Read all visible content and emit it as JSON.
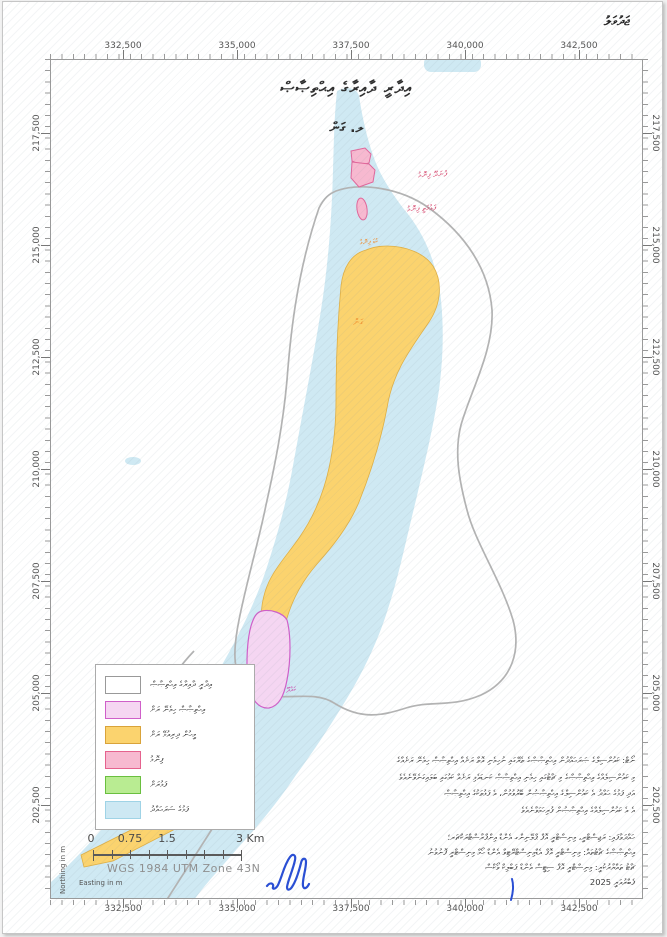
{
  "page": {
    "annex_label": "ޖަދުވަލު",
    "date_label": "ފެބްރުއަރީ 2025"
  },
  "map": {
    "title_line1": "އިދާރީ ދާއިރާގެ އިޙްތިޞާޞް",
    "title_line2": "ލ. ގަން",
    "island_labels": {
      "finolhu_north": "ފުނަދޫ ފިނޮޅު",
      "finolhu_mid": "ފަޅުމަތީ ފިނޮޅު",
      "finolhu_small": "ކުޑަ ފިނޮޅު",
      "gan": "ގަން",
      "kahdhoo": "ކައްދޫ"
    },
    "colors": {
      "lagoon": "#cfe9f3",
      "inhabited_island": "#fbd36e",
      "jurisdiction_island": "#f5d6f2",
      "sandbank": "#f7b9d0",
      "uninhabited_island": "#b9ec92",
      "boundary": "#b3b3b3",
      "label_red": "#d6486e",
      "label_orange": "#ef8d2f",
      "label_magenta": "#cc3fa8",
      "signature_blue": "#2a4fd4"
    }
  },
  "axes": {
    "top": [
      "332,500",
      "335,000",
      "337,500",
      "340,000",
      "342,500"
    ],
    "bottom": [
      "332,500",
      "335,000",
      "337,500",
      "340,000",
      "342,500"
    ],
    "left": [
      "217,500",
      "215,000",
      "212,500",
      "210,000",
      "207,500",
      "205,000",
      "202,500"
    ],
    "right": [
      "217,500",
      "215,000",
      "212,500",
      "210,000",
      "207,500",
      "205,000",
      "202,500"
    ],
    "x_axis_label": "Easting in m",
    "y_axis_label": "Northing in m"
  },
  "legend": {
    "items": [
      {
        "label": "އިދާރީ ދާއިރާގެ އިޙްތިޞާޞް",
        "fill": "#ffffff",
        "stroke": "#999999"
      },
      {
        "label": "އިޙްތިޞާޞް ހިމެނޭ ރަށް",
        "fill": "#f5d6f2",
        "stroke": "#cf5fc9"
      },
      {
        "label": "މީހުން ދިރިއުޅޭ ރަށް",
        "fill": "#fbd36e",
        "stroke": "#d9a33a"
      },
      {
        "label": "ފިނޮޅު",
        "fill": "#f7b9d0",
        "stroke": "#e5628e"
      },
      {
        "label": "ފަޅުރަށް",
        "fill": "#b9ec92",
        "stroke": "#6abf3f"
      },
      {
        "label": "ފަޅުގެ ސަރަޙައްދު",
        "fill": "#cde8f3",
        "stroke": "#9fd3e6"
      }
    ]
  },
  "scalebar": {
    "labels": [
      "0",
      "0.75",
      "1.5",
      "3 Km"
    ],
    "crs": "WGS 1984 UTM Zone 43N"
  },
  "notes": {
    "lines": [
      "ނޯޓް: ކައުންސިލްގެ ޞަރަޙައްދުން އިޙްތިޞާޞްގެ ތެރޭގައި ނުހިމެނި އޮތް ރަށެއް އިޙްތިޞާޞް ހިމެނޭ ރަށެއްގެ",
      "މި ކައުންސިލެއްގެ އިޙްތިޞާޞްގެ މި ޗާޓުގައި ހިމެނި އިޙްތިޞާޞް ކަނޑައެޅި ރަށެއް ކަމުގައި ބަލައިގަނެވޭނެއެވެ",
      "އަދި ފަޅުގެ ޙައްދު އެ ކައުންސިލްގެ އިޙްތިޞާޞުން ބޭރުވުމުން، އެ ފަޅުތަކުގެ އިޙްތިޞާޞް",
      "އެ އެ ކައުންސިލެއްގެ އިޙްތިޞާޞުން ފުރިހަމަވާނެއެވެ"
    ]
  },
  "credits": {
    "lines": [
      "ހައްދަވާފައި: ރަޖިސްޓްރީ، މިނިސްޓްރީ އޮފް ޕްލޭނިންގ އެންޑް އިންފްރާސްޓްރަކްޗަރ؛",
      "އިޙްތިޞާޞްގެ ޗާޓުތައް: މިނިސްޓްރީ އޮފް އެޑްމިނިސްޓްރޭޓިވް އެންޑް ހޯމް މިނިސްޓްރީ ފޮނުވުނު",
      "ޗާޓު ތައްޔާރުކުރީ: މިނިސްޓްރީ އޮފް ސިޓީސް އެންޑް ޕަބްލިކް ވޯކްސް"
    ]
  }
}
